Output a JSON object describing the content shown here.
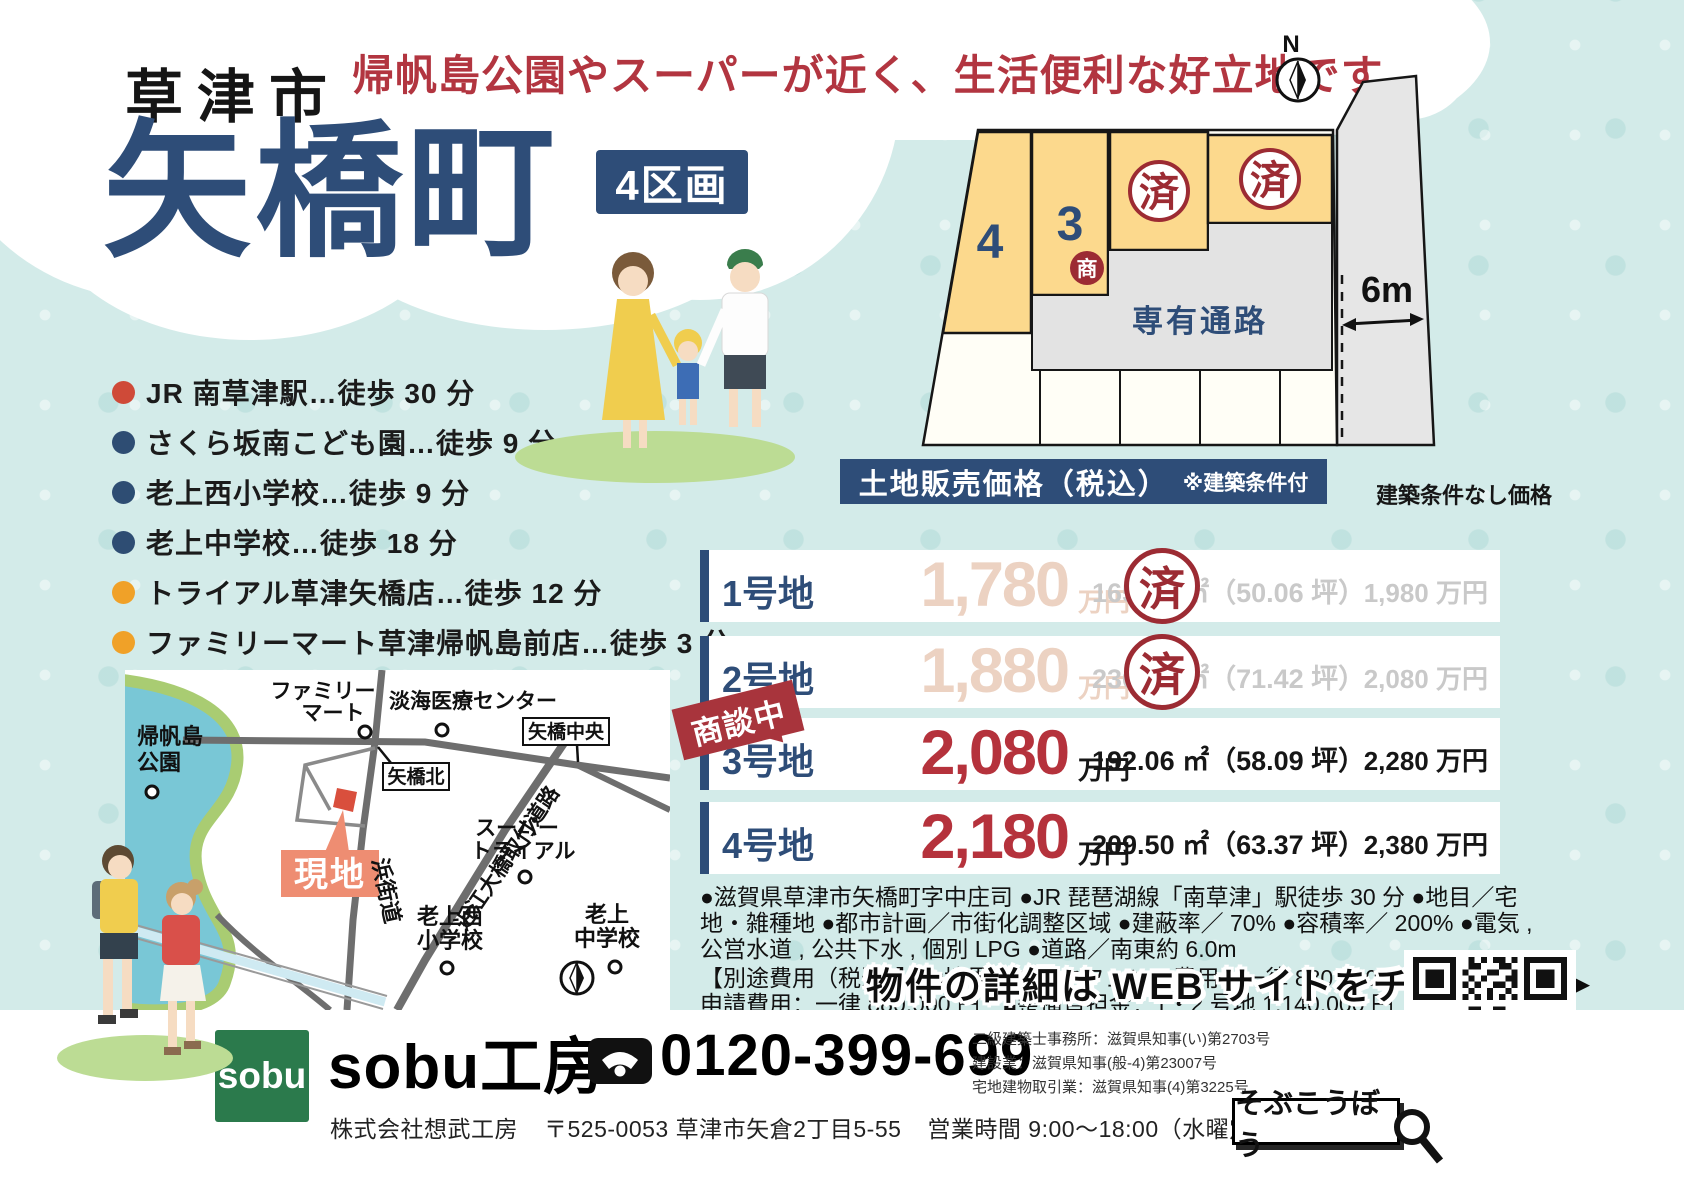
{
  "colors": {
    "bg": "#d3ebe9",
    "navy": "#2e4d78",
    "headline-red": "#b23540",
    "stamp-red": "#9c2b33",
    "price-red": "#b5323c",
    "plot-yellow": "#fcd98d",
    "passage-gray": "#e3e3e3",
    "genchi-orange": "#ee8d72",
    "sobu-green": "#2b7a4c",
    "faded-pink": "#ecd2c2",
    "faded-gray": "#c9c9c9"
  },
  "header": {
    "city": "草津市",
    "town": "矢橋町",
    "lots_badge": "4区画",
    "headline": "帰帆島公園やスーパーが近く、生活便利な好立地です"
  },
  "site_plan": {
    "compass": "N",
    "lot4": "4",
    "lot3": "3",
    "lot3_badge": "商",
    "sold_stamp": "済",
    "passage": "専有通路",
    "road_width": "6m"
  },
  "access": {
    "items": [
      {
        "bullet": "#cf4a38",
        "text": "JR 南草津駅…徒歩 30 分"
      },
      {
        "bullet": "#2e4d73",
        "text": "さくら坂南こども園…徒歩 9 分"
      },
      {
        "bullet": "#2e4d73",
        "text": "老上西小学校…徒歩 9 分"
      },
      {
        "bullet": "#2e4d73",
        "text": "老上中学校…徒歩 18 分"
      },
      {
        "bullet": "#f0a128",
        "text": "トライアル草津矢橋店…徒歩 12 分"
      },
      {
        "bullet": "#f0a128",
        "text": "ファミリーマート草津帰帆島前店…徒歩 3 分"
      }
    ]
  },
  "price_table": {
    "header": "土地販売価格（税込）",
    "header_note": "※建築条件付",
    "right_header": "建築条件なし価格",
    "negotiating_badge": "商談中",
    "rows": [
      {
        "lot": "1号地",
        "price": "1,780",
        "unit": "万円",
        "area": "165.49 ㎡（50.06 坪）",
        "nc_price": "1,980 万円",
        "status": "sold",
        "stamp": "済"
      },
      {
        "lot": "2号地",
        "price": "1,880",
        "unit": "万円",
        "area": "236.13 ㎡（71.42 坪）",
        "nc_price": "2,080 万円",
        "status": "sold",
        "stamp": "済"
      },
      {
        "lot": "3号地",
        "price": "2,080",
        "unit": "万円",
        "area": "192.06 ㎡（58.09 坪）",
        "nc_price": "2,280 万円",
        "status": "negotiating"
      },
      {
        "lot": "4号地",
        "price": "2,180",
        "unit": "万円",
        "area": "209.50 ㎡（63.37 坪）",
        "nc_price": "2,380 万円",
        "status": "available"
      }
    ]
  },
  "details": {
    "line1": "●滋賀県草津市矢橋町字中庄司 ●JR 琵琶湖線「南草津」駅徒歩 30 分 ●地目／宅地・雑種地 ●都市計画／市街化調整区域 ●建蔽率／ 70% ●容積率／ 200% ●電気 , 公営水道 , 公共下水 , 個別 LPG ●道路／南東約 6.0m",
    "line2": "【別途費用（税込）】　■境界ブロックフェンス費用：一律 880,000 円　■開発許可申請費用：一律 880,000 円　■整備負担金：1・2 号地 1,140,000 円　3・4 号地 1,350,000 円"
  },
  "map": {
    "park_l1": "帰帆島",
    "park_l2": "公園",
    "famima_l1": "ファミリー",
    "famima_l2": "マート",
    "hospital": "淡海医療センター",
    "yabase_chuo": "矢橋中央",
    "yabase_kita": "矢橋北",
    "site_label": "現地",
    "super_l1": "スーパー",
    "super_l2": "トライアル",
    "road_hamakaido": "浜街道",
    "elementary_l1": "老上西",
    "elementary_l2": "小学校",
    "road_ohmi": "近江大橋取付道路",
    "junior_l1": "老上",
    "junior_l2": "中学校"
  },
  "web_banner": {
    "text": "物件の詳細は WEB サイトをチェック♪",
    "arrow": "▶"
  },
  "footer": {
    "logo": "sobu",
    "brand": "sobu工房",
    "phone": "0120-399-699",
    "company": "株式会社想武工房",
    "address": "〒525-0053 草津市矢倉2丁目5-55",
    "hours": "営業時間 9:00～18:00（水曜定休）",
    "licenses": [
      "二級建築士事務所：滋賀県知事(い)第2703号",
      "建設業：滋賀県知事(般-4)第23007号",
      "宅地建物取引業：滋賀県知事(4)第3225号"
    ],
    "search_label": "そぶこうぼう"
  }
}
